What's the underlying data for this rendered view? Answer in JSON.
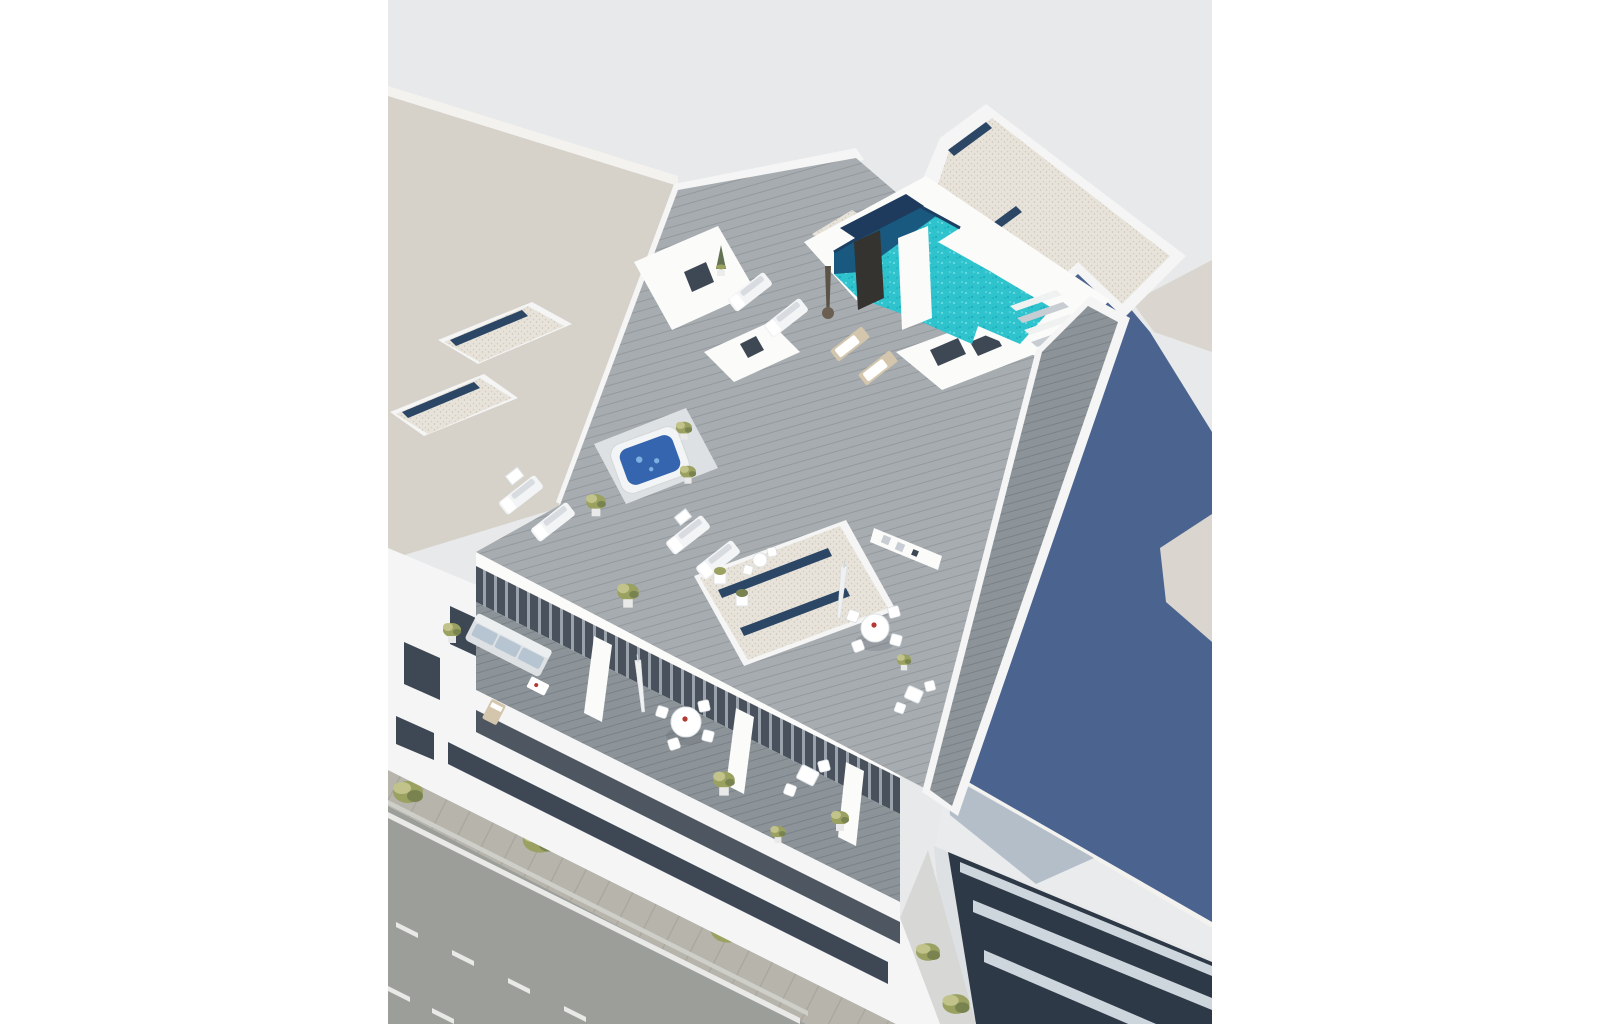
{
  "page": {
    "background": "#ffffff"
  },
  "palette": {
    "bg": "#e8e9ea",
    "beige": "#d6d2ca",
    "beige2": "#dad6cf",
    "beige-edge": "#f3f2ef",
    "white": "#f4f5f4",
    "white-bright": "#fbfbfa",
    "wshade": "#dde1e4",
    "wshade2": "#c7cdd3",
    "blue-wall": "#4a638f",
    "roof-white": "#e9ebed",
    "roof-shadow": "#b4bec9",
    "dark-facade": "#2e3947",
    "light-band": "#cdd5dd",
    "gravel": "#e7e3da",
    "gravel-dot": "#d3ccbe",
    "gravel-dot2": "#c9c2b2",
    "navy": "#2c4666",
    "deck": "#a7acb0",
    "plank": "#94999e",
    "deck-dark": "#8d9499",
    "plank-dark": "#7b8287",
    "pool": "#2fc3ce",
    "pool-deep": "#19597f",
    "pool-fleck": "#79dfe4",
    "pool-fleck2": "#17a9b8",
    "glass": "#49525c",
    "curtain": "#9aa3ab",
    "win": "#3e4854",
    "street": "#9c9e9a",
    "sidewalk": "#b7b4ac",
    "paver": "#a8a59c",
    "white-line": "#e9eae7",
    "curb": "#cfcfc9",
    "tree": "#9aa161",
    "tree-light": "#c2c38b",
    "tree-dark": "#78834f",
    "furn": "#f3f4f5",
    "furn-shade": "#d8dce0",
    "tan": "#d3c6ac",
    "sofa": "#b7c5d3",
    "tub-water": "#3565ae",
    "tub-light": "#7fb0e2",
    "red": "#b23a31",
    "dark": "#34332f",
    "alley": "#d7d8d5"
  }
}
